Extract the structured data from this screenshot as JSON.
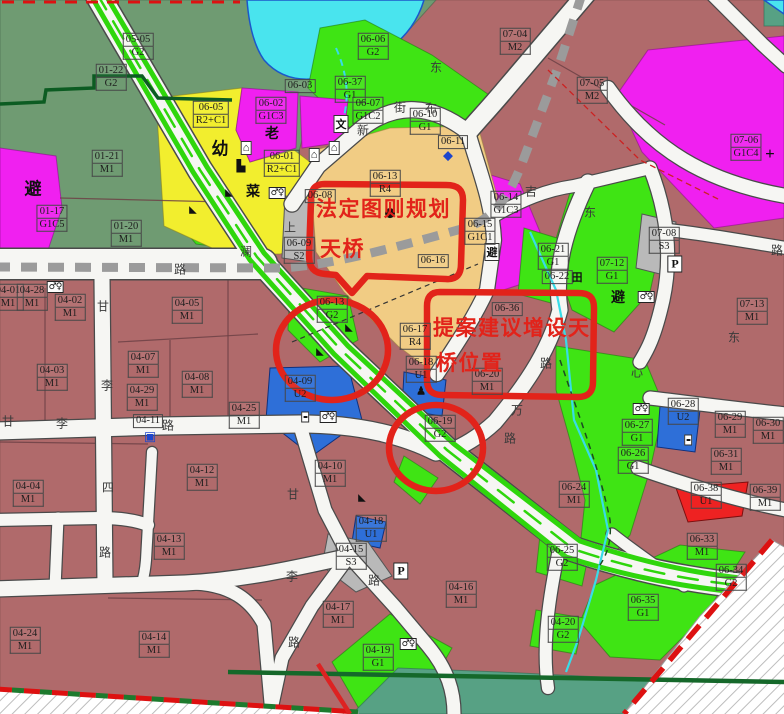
{
  "palette": {
    "m1": "#b06a6b",
    "sage": "#6f9b72",
    "park": "#3fe414",
    "stripGreen": "#2fd60c",
    "yellow": "#f2ee2e",
    "tan": "#f1cc84",
    "magenta": "#f020f0",
    "cyan": "#49e4ee",
    "blue": "#2e6fd8",
    "gray": "#b9b9b9",
    "redParcel": "#ee2222",
    "teal": "#57a184",
    "road": "#f6f6f3",
    "roadEdge": "#4a4a4a",
    "metro": "#9b9b9b",
    "annotation": "#e2231a",
    "boundaryGreen": "#15682a",
    "labelText": "#1d1d1d"
  },
  "annotations": [
    {
      "id": "statutory-plan-bridge",
      "lines": [
        "法定图则规划",
        "天桥"
      ]
    },
    {
      "id": "proposed-bridge-location",
      "lines": [
        "提案建议增设天",
        "桥位置"
      ]
    }
  ],
  "parcels": [
    {
      "code": "05-05",
      "use": "G2",
      "x": 138,
      "y": 46
    },
    {
      "code": "01-22",
      "use": "G2",
      "x": 111,
      "y": 77
    },
    {
      "code": "06-06",
      "use": "G2",
      "x": 373,
      "y": 46
    },
    {
      "code": "06-37",
      "use": "G1",
      "x": 350,
      "y": 89
    },
    {
      "code": "07-04",
      "use": "M2",
      "x": 515,
      "y": 41
    },
    {
      "code": "07-05",
      "use": "M2",
      "x": 592,
      "y": 90
    },
    {
      "code": "07-06",
      "use": "G1C4",
      "x": 746,
      "y": 147
    },
    {
      "code": "06-05",
      "use": "R2+C1",
      "x": 211,
      "y": 114
    },
    {
      "code": "06-02",
      "use": "G1C3",
      "x": 271,
      "y": 110
    },
    {
      "code": "06-07",
      "use": "G1C2",
      "x": 368,
      "y": 110
    },
    {
      "code": "06-03",
      "use": "",
      "x": 300,
      "y": 86
    },
    {
      "code": "06-01",
      "use": "R2+C1",
      "x": 282,
      "y": 163
    },
    {
      "code": "01-21",
      "use": "M1",
      "x": 107,
      "y": 163
    },
    {
      "code": "01-20",
      "use": "M1",
      "x": 126,
      "y": 233
    },
    {
      "code": "01-17",
      "use": "G1C5",
      "x": 52,
      "y": 218
    },
    {
      "code": "06-08",
      "use": "",
      "x": 320,
      "y": 196
    },
    {
      "code": "06-09",
      "use": "S2",
      "x": 299,
      "y": 250
    },
    {
      "code": "06-13",
      "use": "R4",
      "x": 385,
      "y": 183
    },
    {
      "code": "06-10",
      "use": "G1",
      "x": 425,
      "y": 121
    },
    {
      "code": "06-11",
      "use": "",
      "x": 453,
      "y": 142
    },
    {
      "code": "06-14",
      "use": "G1C3",
      "x": 506,
      "y": 204
    },
    {
      "code": "06-15",
      "use": "G1C1",
      "x": 480,
      "y": 231
    },
    {
      "code": "06-16",
      "use": "",
      "x": 433,
      "y": 261
    },
    {
      "code": "06-21",
      "use": "G1",
      "x": 553,
      "y": 256
    },
    {
      "code": "06-22",
      "use": "",
      "x": 557,
      "y": 277
    },
    {
      "code": "07-12",
      "use": "G1",
      "x": 612,
      "y": 270
    },
    {
      "code": "07-08",
      "use": "S3",
      "x": 664,
      "y": 240
    },
    {
      "code": "07-13",
      "use": "M1",
      "x": 752,
      "y": 311
    },
    {
      "code": "06-36",
      "use": "",
      "x": 507,
      "y": 309
    },
    {
      "code": "06-17",
      "use": "R4",
      "x": 415,
      "y": 336
    },
    {
      "code": "06-18",
      "use": "U1",
      "x": 421,
      "y": 369
    },
    {
      "code": "06-20",
      "use": "M1",
      "x": 487,
      "y": 381
    },
    {
      "code": "06-19",
      "use": "G2",
      "x": 440,
      "y": 428
    },
    {
      "code": "06-13",
      "use": "G2",
      "x": 332,
      "y": 309
    },
    {
      "code": "04-01",
      "use": "M1",
      "x": 8,
      "y": 297
    },
    {
      "code": "04-28",
      "use": "M1",
      "x": 32,
      "y": 297
    },
    {
      "code": "04-02",
      "use": "M1",
      "x": 70,
      "y": 307
    },
    {
      "code": "04-05",
      "use": "M1",
      "x": 187,
      "y": 310
    },
    {
      "code": "04-09",
      "use": "U2",
      "x": 300,
      "y": 388
    },
    {
      "code": "04-03",
      "use": "M1",
      "x": 52,
      "y": 377
    },
    {
      "code": "04-07",
      "use": "M1",
      "x": 143,
      "y": 364
    },
    {
      "code": "04-29",
      "use": "M1",
      "x": 142,
      "y": 397
    },
    {
      "code": "04-08",
      "use": "M1",
      "x": 197,
      "y": 384
    },
    {
      "code": "04-25",
      "use": "M1",
      "x": 244,
      "y": 415
    },
    {
      "code": "04-11",
      "use": "",
      "x": 148,
      "y": 421
    },
    {
      "code": "04-04",
      "use": "M1",
      "x": 28,
      "y": 493
    },
    {
      "code": "04-12",
      "use": "M1",
      "x": 202,
      "y": 477
    },
    {
      "code": "04-10",
      "use": "M1",
      "x": 330,
      "y": 473
    },
    {
      "code": "04-13",
      "use": "M1",
      "x": 169,
      "y": 546
    },
    {
      "code": "04-24",
      "use": "M1",
      "x": 25,
      "y": 640
    },
    {
      "code": "04-14",
      "use": "M1",
      "x": 154,
      "y": 644
    },
    {
      "code": "04-17",
      "use": "M1",
      "x": 338,
      "y": 614
    },
    {
      "code": "04-16",
      "use": "M1",
      "x": 461,
      "y": 594
    },
    {
      "code": "04-19",
      "use": "G1",
      "x": 378,
      "y": 657
    },
    {
      "code": "04-15",
      "use": "S3",
      "x": 351,
      "y": 556
    },
    {
      "code": "04-18",
      "use": "U1",
      "x": 371,
      "y": 528
    },
    {
      "code": "04-20",
      "use": "G2",
      "x": 563,
      "y": 629
    },
    {
      "code": "06-24",
      "use": "M1",
      "x": 574,
      "y": 494
    },
    {
      "code": "06-27",
      "use": "G1",
      "x": 637,
      "y": 432
    },
    {
      "code": "06-26",
      "use": "G1",
      "x": 633,
      "y": 460
    },
    {
      "code": "06-28",
      "use": "U2",
      "x": 683,
      "y": 411
    },
    {
      "code": "06-29",
      "use": "M1",
      "x": 730,
      "y": 424
    },
    {
      "code": "06-30",
      "use": "M1",
      "x": 768,
      "y": 430
    },
    {
      "code": "06-31",
      "use": "M1",
      "x": 726,
      "y": 461
    },
    {
      "code": "06-38",
      "use": "U1",
      "x": 706,
      "y": 495
    },
    {
      "code": "06-39",
      "use": "M1",
      "x": 765,
      "y": 497
    },
    {
      "code": "06-33",
      "use": "M1",
      "x": 702,
      "y": 546
    },
    {
      "code": "06-34",
      "use": "G2",
      "x": 731,
      "y": 577
    },
    {
      "code": "06-35",
      "use": "G1",
      "x": 643,
      "y": 607
    },
    {
      "code": "06-25",
      "use": "G2",
      "x": 562,
      "y": 557
    }
  ],
  "road_labels": [
    {
      "text": "澜",
      "x": 246,
      "y": 251
    },
    {
      "text": "路",
      "x": 180,
      "y": 269
    },
    {
      "text": "上",
      "x": 290,
      "y": 227
    },
    {
      "text": "甘",
      "x": 103,
      "y": 306
    },
    {
      "text": "李",
      "x": 107,
      "y": 385
    },
    {
      "text": "四",
      "x": 108,
      "y": 487
    },
    {
      "text": "路",
      "x": 105,
      "y": 552
    },
    {
      "text": "甘",
      "x": 8,
      "y": 421
    },
    {
      "text": "李",
      "x": 62,
      "y": 423
    },
    {
      "text": "路",
      "x": 168,
      "y": 425
    },
    {
      "text": "甘",
      "x": 293,
      "y": 494
    },
    {
      "text": "李",
      "x": 292,
      "y": 576
    },
    {
      "text": "路",
      "x": 294,
      "y": 642
    },
    {
      "text": "路",
      "x": 374,
      "y": 580
    },
    {
      "text": "万",
      "x": 517,
      "y": 410
    },
    {
      "text": "路",
      "x": 510,
      "y": 438
    },
    {
      "text": "心",
      "x": 637,
      "y": 372
    },
    {
      "text": "路",
      "x": 546,
      "y": 363
    },
    {
      "text": "东",
      "x": 590,
      "y": 212
    },
    {
      "text": "路",
      "x": 777,
      "y": 250
    },
    {
      "text": "东",
      "x": 734,
      "y": 337
    },
    {
      "text": "吉",
      "x": 531,
      "y": 191
    },
    {
      "text": "新",
      "x": 363,
      "y": 130
    },
    {
      "text": "街",
      "x": 400,
      "y": 107
    },
    {
      "text": "布",
      "x": 431,
      "y": 108
    },
    {
      "text": "东",
      "x": 436,
      "y": 67
    }
  ],
  "poi": [
    {
      "name": "kindergarten-char",
      "glyph": "幼",
      "cls": "char-lg",
      "x": 220,
      "y": 147
    },
    {
      "name": "facility-icon",
      "glyph": "⌂",
      "cls": "boxed",
      "x": 246,
      "y": 148
    },
    {
      "name": "boat-icon",
      "glyph": "▙",
      "cls": "char-sm",
      "x": 241,
      "y": 166
    },
    {
      "name": "elderly-char",
      "glyph": "老",
      "cls": "char-md",
      "x": 272,
      "y": 133
    },
    {
      "name": "market-char",
      "glyph": "菜",
      "cls": "char-md",
      "x": 253,
      "y": 191
    },
    {
      "name": "toilet-icon",
      "glyph": "♂♀",
      "cls": "toilets",
      "x": 277,
      "y": 193
    },
    {
      "name": "culture-char",
      "glyph": "文",
      "cls": "boxed",
      "x": 341,
      "y": 124
    },
    {
      "name": "house-icon",
      "glyph": "⌂",
      "cls": "boxed",
      "x": 314,
      "y": 155
    },
    {
      "name": "house-icon",
      "glyph": "⌂",
      "cls": "boxed",
      "x": 334,
      "y": 148
    },
    {
      "name": "slope-icon",
      "glyph": "◣",
      "cls": "flag",
      "x": 193,
      "y": 210
    },
    {
      "name": "slope-icon",
      "glyph": "◣",
      "cls": "flag",
      "x": 229,
      "y": 193
    },
    {
      "name": "shelter-char",
      "glyph": "避",
      "cls": "char-lg",
      "x": 33,
      "y": 187
    },
    {
      "name": "toilet-icon",
      "glyph": "♂♀",
      "cls": "toilets",
      "x": 55,
      "y": 287
    },
    {
      "name": "shelter-char",
      "glyph": "避",
      "cls": "boxed",
      "x": 492,
      "y": 252
    },
    {
      "name": "shelter-char",
      "glyph": "避",
      "cls": "char-md",
      "x": 618,
      "y": 297
    },
    {
      "name": "toilet-icon",
      "glyph": "♂♀",
      "cls": "toilets",
      "x": 646,
      "y": 297
    },
    {
      "name": "toilet-icon",
      "glyph": "♂♀",
      "cls": "toilets",
      "x": 641,
      "y": 409
    },
    {
      "name": "substation-icon",
      "glyph": "▪▪",
      "cls": "boxed-sm",
      "x": 305,
      "y": 417
    },
    {
      "name": "toilet-icon",
      "glyph": "♂♀",
      "cls": "toilets",
      "x": 328,
      "y": 417
    },
    {
      "name": "toilet-icon",
      "glyph": "♂♀",
      "cls": "toilets",
      "x": 408,
      "y": 644
    },
    {
      "name": "parking-icon",
      "glyph": "P",
      "cls": "pbox",
      "x": 675,
      "y": 264
    },
    {
      "name": "parking-icon",
      "glyph": "P",
      "cls": "pbox",
      "x": 401,
      "y": 571
    },
    {
      "name": "hospital-cross-icon",
      "glyph": "+",
      "cls": "char-lg",
      "x": 770,
      "y": 154
    },
    {
      "name": "farmland-char",
      "glyph": "田",
      "cls": "char-sm",
      "x": 577,
      "y": 277
    },
    {
      "name": "station-icon",
      "glyph": "◆",
      "cls": "glyph-blue",
      "x": 448,
      "y": 156
    },
    {
      "name": "bus-icon",
      "glyph": "▣",
      "cls": "glyph-blue",
      "x": 150,
      "y": 437
    },
    {
      "name": "person-icon",
      "glyph": "♟",
      "cls": "char-sm",
      "x": 421,
      "y": 391
    },
    {
      "name": "slope-icon",
      "glyph": "◣",
      "cls": "flag",
      "x": 349,
      "y": 328
    },
    {
      "name": "slope-icon",
      "glyph": "◣",
      "cls": "flag",
      "x": 320,
      "y": 352
    },
    {
      "name": "bridge-dot-icon",
      "glyph": "●",
      "cls": "disc",
      "x": 390,
      "y": 213
    },
    {
      "name": "slope-icon",
      "glyph": "◣",
      "cls": "flag",
      "x": 362,
      "y": 498
    },
    {
      "name": "substation-icon",
      "glyph": "▪▪",
      "cls": "boxed-sm",
      "x": 688,
      "y": 440
    }
  ]
}
